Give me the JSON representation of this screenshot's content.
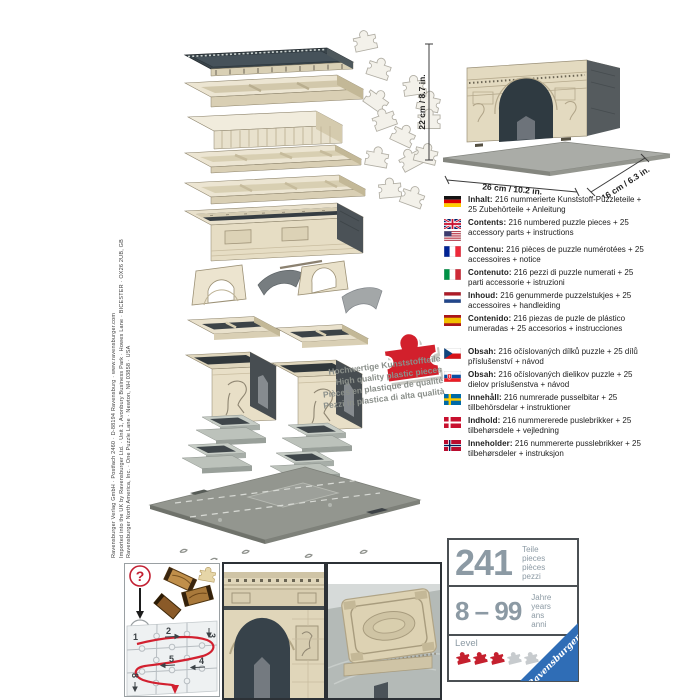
{
  "title": "Ravensburger 3D Puzzle Arc de Triomphe – box back panel",
  "imprint": {
    "line1": "Ravensburger Verlag GmbH · Postfach 2460 · D-88194 Ravensburg · www.ravensburger.com",
    "line2": "Imported into the UK by Ravensburger Ltd. · Unit 1, Avonbury Business Park · Howes Lane · BICESTER · OX26 2UB, GB",
    "line3": "Ravensburger North America, Inc. · One Puzzle Lane · Newton, NH 03858 · USA"
  },
  "model_dimensions": {
    "height_label": "22 cm / 8.7 in.",
    "width_label": "26 cm / 10.2 in.",
    "depth_label": "16 cm / 6.3 in."
  },
  "quality_note": {
    "line1": "Hochwertige Kunststoffteile",
    "line2": "High quality plastic pieces",
    "line3": "Pièces en plastique de qualité",
    "line4": "Pezzi in plastica di alta qualità"
  },
  "contents": [
    {
      "id": "de",
      "flag": "germany",
      "label": "Inhalt:",
      "text": "216 nummerierte Kunststoff-Puzzleteile + 25 Zubehörteile + Anleitung"
    },
    {
      "id": "en",
      "flag": "uk-us",
      "label": "Contents:",
      "text": "216 numbered puzzle pieces + 25 accessory parts + instructions"
    },
    {
      "id": "fr",
      "flag": "france",
      "label": "Contenu:",
      "text": "216 pièces de puzzle numérotées + 25 accessoires + notice"
    },
    {
      "id": "it",
      "flag": "italy",
      "label": "Contenuto:",
      "text": "216 pezzi di puzzle numerati + 25 parti accessorie + istruzioni"
    },
    {
      "id": "nl",
      "flag": "netherlands",
      "label": "Inhoud:",
      "text": "216 genummerde puzzelstukjes + 25 accessoires + handleiding"
    },
    {
      "id": "es",
      "flag": "spain",
      "label": "Contenido:",
      "text": "216 piezas de puzle de plástico numeradas + 25 accesorios + instrucciones"
    },
    {
      "id": "cs",
      "flag": "czech-republic",
      "label": "Obsah:",
      "text": "216 očíslovaných dílků puzzle + 25 dílů příslušenství + návod"
    },
    {
      "id": "sk",
      "flag": "slovakia",
      "label": "Obsah:",
      "text": "216 očíslovaných dielikov puzzle + 25 dielov príslušenstva + návod"
    },
    {
      "id": "sv",
      "flag": "sweden",
      "label": "Innehåll:",
      "text": "216 numrerade pusselbitar + 25 tillbehörsdelar + instruktioner"
    },
    {
      "id": "da",
      "flag": "denmark",
      "label": "Indhold:",
      "text": "216 nummererede puslebrikker + 25 tilbehørsdele + vejledning"
    },
    {
      "id": "no",
      "flag": "norway",
      "label": "Inneholder:",
      "text": "216 nummererte pusslebrikker + 25 tilbehørsdeler + instruksjon"
    }
  ],
  "info_box": {
    "pieces_value": "241",
    "pieces_labels": [
      "Teile",
      "pieces",
      "pièces",
      "pezzi"
    ],
    "age_value": "8 – 99",
    "age_labels": [
      "Jahre",
      "years",
      "ans",
      "anni"
    ],
    "level_label": "Level",
    "level_filled": 3,
    "level_total": 5,
    "brand": "Ravensburger"
  },
  "assembly_help": {
    "question_mark": "?",
    "exclamation_mark": "!",
    "step_numbers": [
      "1",
      "2",
      "3",
      "4",
      "5",
      "8"
    ]
  },
  "colors": {
    "accent_red": "#d2202c",
    "brand_blue": "#2f6db6",
    "info_gray": "#8c9aa4",
    "stone_beige": "#e6ddc4"
  }
}
